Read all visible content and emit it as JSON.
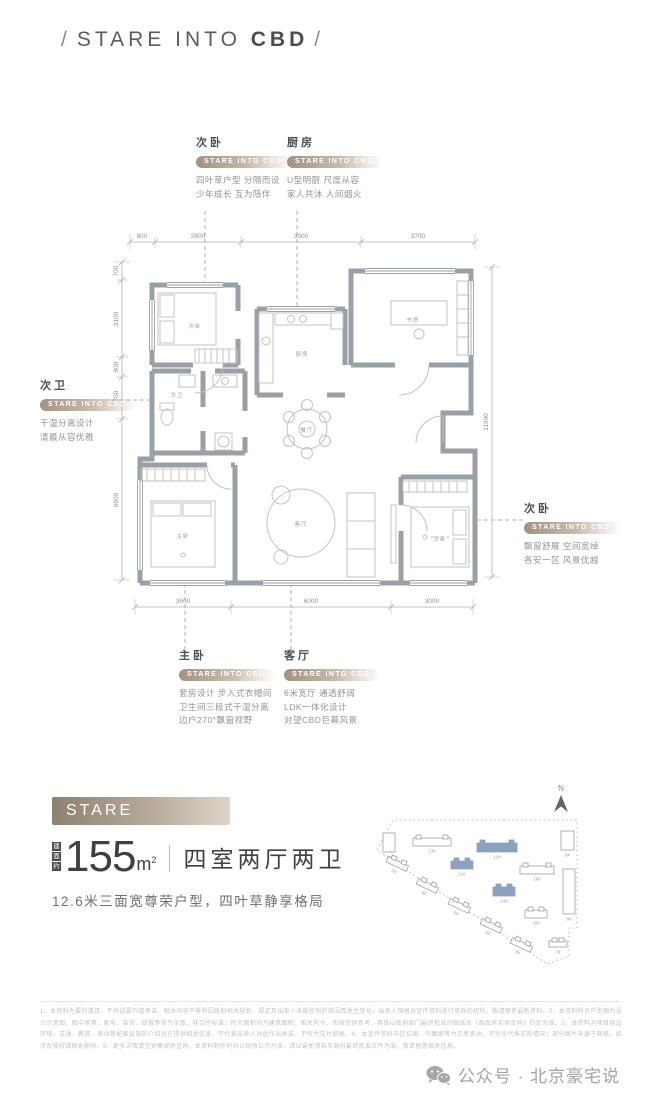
{
  "header": {
    "slash_left": "/",
    "text": "STARE INTO",
    "bold": "CBD",
    "slash_right": "/"
  },
  "callouts": {
    "bedroom_top": {
      "title": "次卧",
      "badge": "STARE INTO CBD",
      "lines": [
        "四叶草户型 分隔而设",
        "少年成长 互为陪伴"
      ]
    },
    "kitchen": {
      "title": "厨房",
      "badge": "STARE INTO CBD",
      "lines": [
        "U型明厨 尺度从容",
        "家人共沐 人间烟火"
      ]
    },
    "bath": {
      "title": "次卫",
      "badge": "STARE INTO CBD",
      "lines": [
        "干湿分离设计",
        "清晨从容优雅"
      ]
    },
    "bedroom_right": {
      "title": "次卧",
      "badge": "STARE INTO CBD",
      "lines": [
        "飘窗舒展 空间宽绰",
        "各安一区 风景优越"
      ]
    },
    "master": {
      "title": "主卧",
      "badge": "STARE INTO CBD",
      "lines": [
        "套房设计 步入式衣帽间",
        "卫生间三段式干湿分离",
        "边户270°飘窗视野"
      ]
    },
    "living": {
      "title": "客厅",
      "badge": "STARE INTO CBD",
      "lines": [
        "6米宽厅 通透舒阔",
        "LDK一体化设计",
        "对望CBD巨幕风景"
      ]
    }
  },
  "plan": {
    "dims_top": [
      "800",
      "2800",
      "3900",
      "3700"
    ],
    "dims_bottom": [
      "3600",
      "6000",
      "3000"
    ],
    "dims_left": [
      "700",
      "3100",
      "800",
      "1700",
      "6600"
    ],
    "dims_right": [
      "11900"
    ],
    "dim_labels": [
      {
        "t": "800",
        "x": 47,
        "y": 123
      },
      {
        "t": "2800",
        "x": 103,
        "y": 123
      },
      {
        "t": "3900",
        "x": 206,
        "y": 123
      },
      {
        "t": "3700",
        "x": 323,
        "y": 123
      },
      {
        "t": "3600",
        "x": 88,
        "y": 488
      },
      {
        "t": "6000",
        "x": 216,
        "y": 488
      },
      {
        "t": "3000",
        "x": 337,
        "y": 488
      },
      {
        "t": "700",
        "x": 23,
        "y": 156,
        "r": -90
      },
      {
        "t": "3100",
        "x": 23,
        "y": 204,
        "r": -90
      },
      {
        "t": "800",
        "x": 23,
        "y": 252,
        "r": -90
      },
      {
        "t": "1700",
        "x": 23,
        "y": 283,
        "r": -90
      },
      {
        "t": "6600",
        "x": 23,
        "y": 385,
        "r": -90
      },
      {
        "t": "11900",
        "x": 393,
        "y": 307,
        "r": -90
      }
    ],
    "room_labels": [
      {
        "t": "次卧",
        "x": 100,
        "y": 213
      },
      {
        "t": "厨房",
        "x": 207,
        "y": 241
      },
      {
        "t": "书房",
        "x": 318,
        "y": 207
      },
      {
        "t": "次卫",
        "x": 82,
        "y": 282
      },
      {
        "t": "餐厅",
        "x": 212,
        "y": 317
      },
      {
        "t": "客厅",
        "x": 206,
        "y": 411
      },
      {
        "t": "主卧",
        "x": 88,
        "y": 423
      },
      {
        "t": "次卧",
        "x": 345,
        "y": 426
      }
    ]
  },
  "summary": {
    "banner_text": "STARE INTO",
    "banner_bold": "CBD",
    "area_prefix_chars": [
      "建",
      "面",
      "约"
    ],
    "area_value": "155",
    "area_unit": "m",
    "area_sup": "2",
    "layout": "四室两厅两卫",
    "description": "12.6米三面宽尊荣户型，四叶草静享格局"
  },
  "siteplan": {
    "north_label": "N",
    "highlight_color": "#8da0c0",
    "boundary": "12,72 28,42 212,42 212,150 204,150 204,178 182,186",
    "buildings": [
      {
        "label": "1#",
        "x": 18,
        "y": 52,
        "w": 12,
        "h": 22,
        "r": 0,
        "hl": false
      },
      {
        "label": "13#",
        "x": 48,
        "y": 57,
        "w": 38,
        "h": 11,
        "r": 0,
        "hl": false
      },
      {
        "label": "12#",
        "x": 112,
        "y": 62,
        "w": 40,
        "h": 12,
        "r": 0,
        "hl": true
      },
      {
        "label": "9#",
        "x": 196,
        "y": 50,
        "w": 13,
        "h": 22,
        "r": 0,
        "hl": false
      },
      {
        "label": "11#",
        "x": 86,
        "y": 80,
        "w": 22,
        "h": 11,
        "r": 0,
        "hl": true
      },
      {
        "label": "10#",
        "x": 155,
        "y": 85,
        "w": 34,
        "h": 11,
        "r": 0,
        "hl": false
      },
      {
        "label": "8#",
        "x": 198,
        "y": 88,
        "w": 12,
        "h": 48,
        "r": 0,
        "hl": false
      },
      {
        "label": "14#",
        "x": 128,
        "y": 106,
        "w": 22,
        "h": 12,
        "r": 0,
        "hl": true
      },
      {
        "label": "15#",
        "x": 160,
        "y": 129,
        "w": 22,
        "h": 11,
        "r": 0,
        "hl": false
      },
      {
        "label": "2#",
        "x": 22,
        "y": 80,
        "w": 22,
        "h": 9,
        "r": 25,
        "hl": false
      },
      {
        "label": "3#",
        "x": 52,
        "y": 102,
        "w": 22,
        "h": 9,
        "r": 25,
        "hl": false
      },
      {
        "label": "4#",
        "x": 84,
        "y": 122,
        "w": 22,
        "h": 9,
        "r": 25,
        "hl": false
      },
      {
        "label": "5#",
        "x": 116,
        "y": 142,
        "w": 22,
        "h": 9,
        "r": 25,
        "hl": false
      },
      {
        "label": "6#",
        "x": 146,
        "y": 161,
        "w": 22,
        "h": 9,
        "r": 25,
        "hl": false
      },
      {
        "label": "7#",
        "x": 184,
        "y": 160,
        "w": 18,
        "h": 9,
        "r": 0,
        "hl": false
      }
    ]
  },
  "disclaimer": {
    "text": "1、本资料为要约邀请，不构成要约或承诺，相关内容不排除因政府相关规划、规定及出卖人未能控制的原因而发生变化，出卖人保留对宣传资料进行修改的权利，敬请留意最新资料。2、本资料所示户型图为设计示意图，图中家具、家电、装饰、绿植等仅为示意，非交付标准；所示面积均为建筑面积，相关尺寸、布局仅供参考，具体以政府部门最终批准的图纸及《商品房买卖合同》约定为准。3、本资料对项目周边环境、交通、教育、商业等配套设施的介绍旨在提供相关信息，不代表出卖人对此作出承诺，不作为交付依据。4、本宣传资料中区位图、鸟瞰图等为示意表达，不完全代表实际情况；部分图片来源于网络，如涉及侵权请联系删除。5、更多详情请至销售现场咨询，本资料制作时间以现场公示为准，请以最新资料及政府最终批准文件为准，敬请留意相关信息。"
  },
  "footer": {
    "text": "公众号 · 北京豪宅说"
  }
}
